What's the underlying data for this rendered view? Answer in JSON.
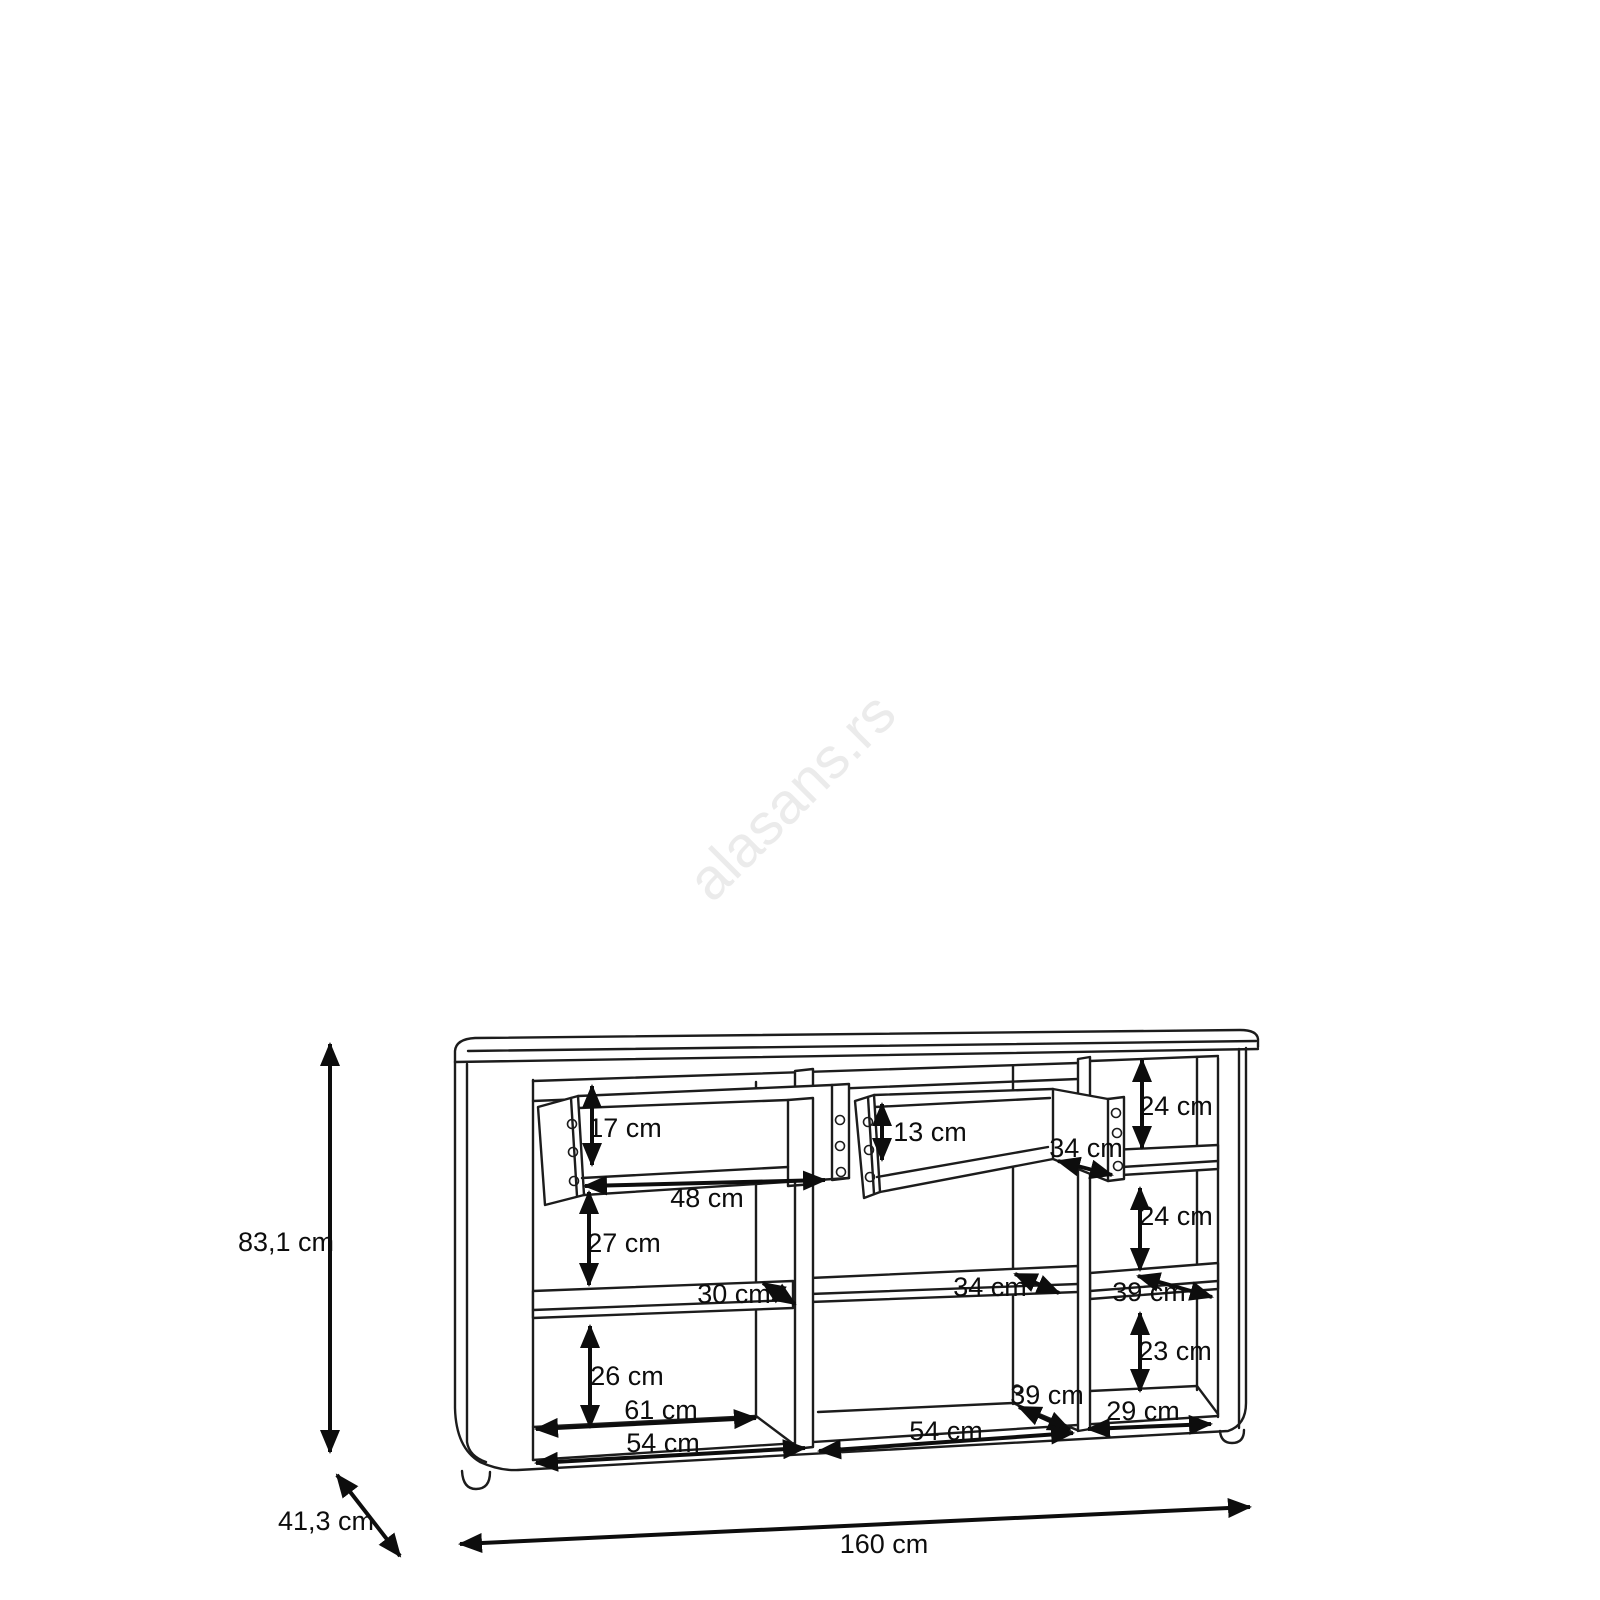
{
  "watermark": {
    "text": "alasans.rs"
  },
  "overall": {
    "height": "83,1 cm",
    "depth": "41,3 cm",
    "width": "160 cm"
  },
  "drawers": {
    "left": {
      "front_height": "17 cm",
      "width": "48 cm"
    },
    "right": {
      "front_height": "13 cm",
      "depth": "34 cm"
    }
  },
  "left_column": {
    "below_drawer_height": "27 cm",
    "shelf_depth": "30 cm",
    "bottom_height": "26 cm",
    "inner_width": "61 cm",
    "width": "54 cm"
  },
  "middle_column": {
    "shelf_depth": "34 cm",
    "floor_depth": "39 cm",
    "width": "54 cm"
  },
  "right_column": {
    "top_height": "24 cm",
    "middle_height": "24 cm",
    "shelf_depth": "39 cm",
    "bottom_height": "23 cm",
    "width": "29 cm"
  }
}
